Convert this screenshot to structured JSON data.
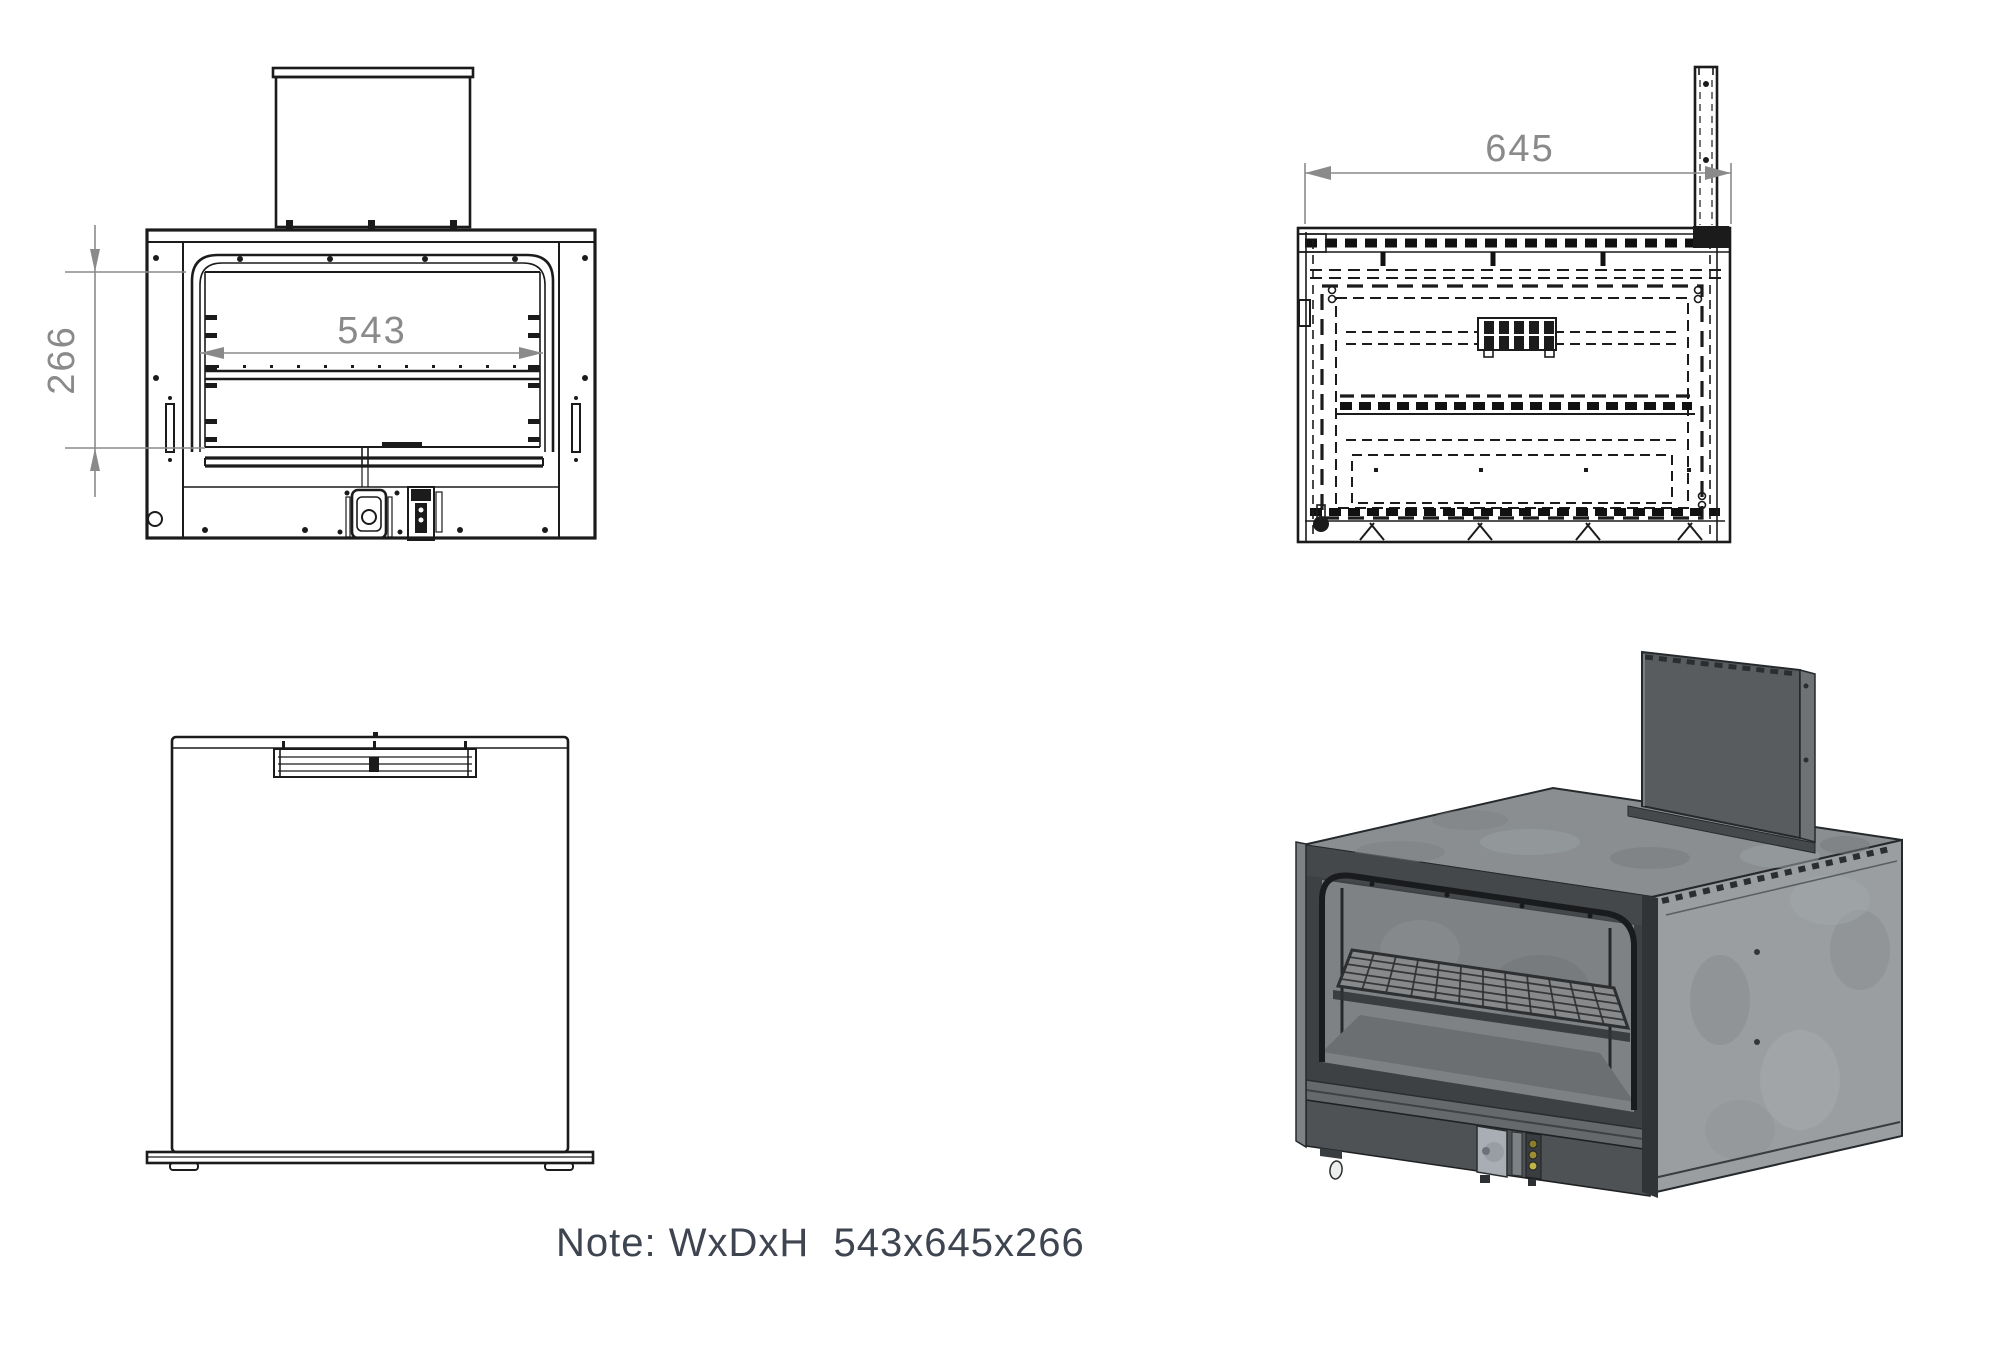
{
  "note": {
    "text": "Note: WxDxH  543x645x266"
  },
  "dimensions": {
    "width": "543",
    "depth": "645",
    "height": "266"
  },
  "colors": {
    "background": "#ffffff",
    "line": "#1b1b1b",
    "dimension_gray": "#8a8a8a",
    "note_text": "#3e4550",
    "iso_top_face": "#8a8e90",
    "iso_side_face": "#9a9ea0",
    "iso_front_face": "#3e4144",
    "iso_back_panel": "#595c5e",
    "iso_interior": "#7e8284",
    "iso_valve": "#a9aeb4",
    "iso_igniter_yellow": "#c0b446"
  }
}
